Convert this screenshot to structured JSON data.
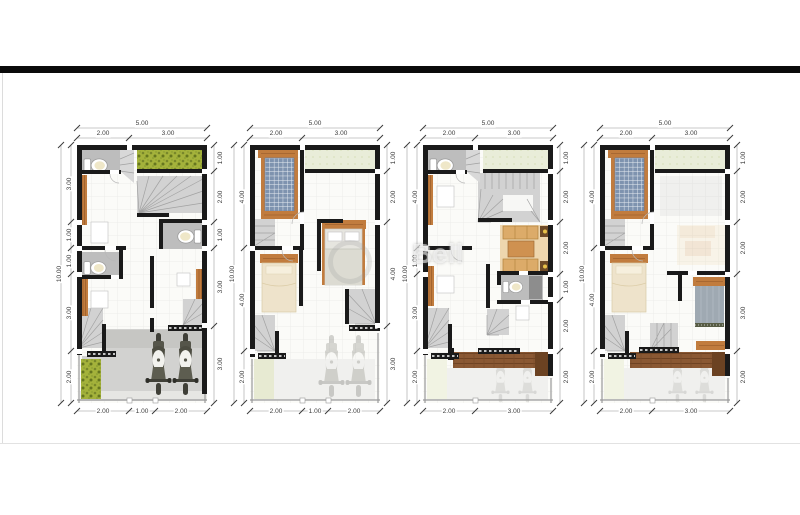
{
  "page": {
    "background": "#ffffff"
  },
  "watermark": {
    "text": "Bell"
  },
  "palette": {
    "top_bar": "#0a0a0a",
    "wall": "#1a1a1a",
    "wood": "#c17c3e",
    "hedge_green": "#a4b23b",
    "balcony_green": "#e9edd9",
    "stair": "#d2d2d2",
    "bath_floor": "#bdbdbd",
    "concrete": "#d2d2d0",
    "deck_brown": "#8a5833",
    "bed_blue": "#7e93af",
    "bed_cream": "#eee3cb",
    "dim_text": "#3c3c3c"
  },
  "plans": [
    {
      "id": "floor-plan-1",
      "top_total": "5.00",
      "top_segments": [
        "2.00",
        "3.00"
      ],
      "bottom_segments": [
        "2.00",
        "1.00",
        "2.00"
      ],
      "left_total": "10.00",
      "left_segments": [
        "3.00",
        "1.00",
        "1.00",
        "3.00",
        "2.00"
      ],
      "right_segments": [
        "1.00",
        "2.00",
        "1.00",
        "3.00",
        "3.00"
      ]
    },
    {
      "id": "floor-plan-2",
      "top_total": "5.00",
      "top_segments": [
        "2.00",
        "3.00"
      ],
      "bottom_segments": [
        "2.00",
        "1.00",
        "2.00"
      ],
      "left_total": "10.00",
      "left_segments": [
        "4.00",
        "4.00",
        "2.00"
      ],
      "right_segments": [
        "1.00",
        "2.00",
        "4.00",
        "3.00"
      ]
    },
    {
      "id": "floor-plan-3",
      "top_total": "5.00",
      "top_segments": [
        "2.00",
        "3.00"
      ],
      "bottom_segments": [
        "2.00",
        "3.00"
      ],
      "left_total": "10.00",
      "left_segments": [
        "4.00",
        "1.00",
        "3.00",
        "2.00"
      ],
      "right_segments": [
        "1.00",
        "2.00",
        "2.00",
        "1.00",
        "2.00",
        "2.00"
      ]
    },
    {
      "id": "floor-plan-4",
      "top_total": "5.00",
      "top_segments": [
        "2.00",
        "3.00"
      ],
      "bottom_segments": [
        "2.00",
        "3.00"
      ],
      "left_total": "10.00",
      "left_segments": [
        "4.00",
        "4.00",
        "2.00"
      ],
      "right_segments": [
        "1.00",
        "2.00",
        "2.00",
        "3.00",
        "2.00"
      ]
    }
  ]
}
